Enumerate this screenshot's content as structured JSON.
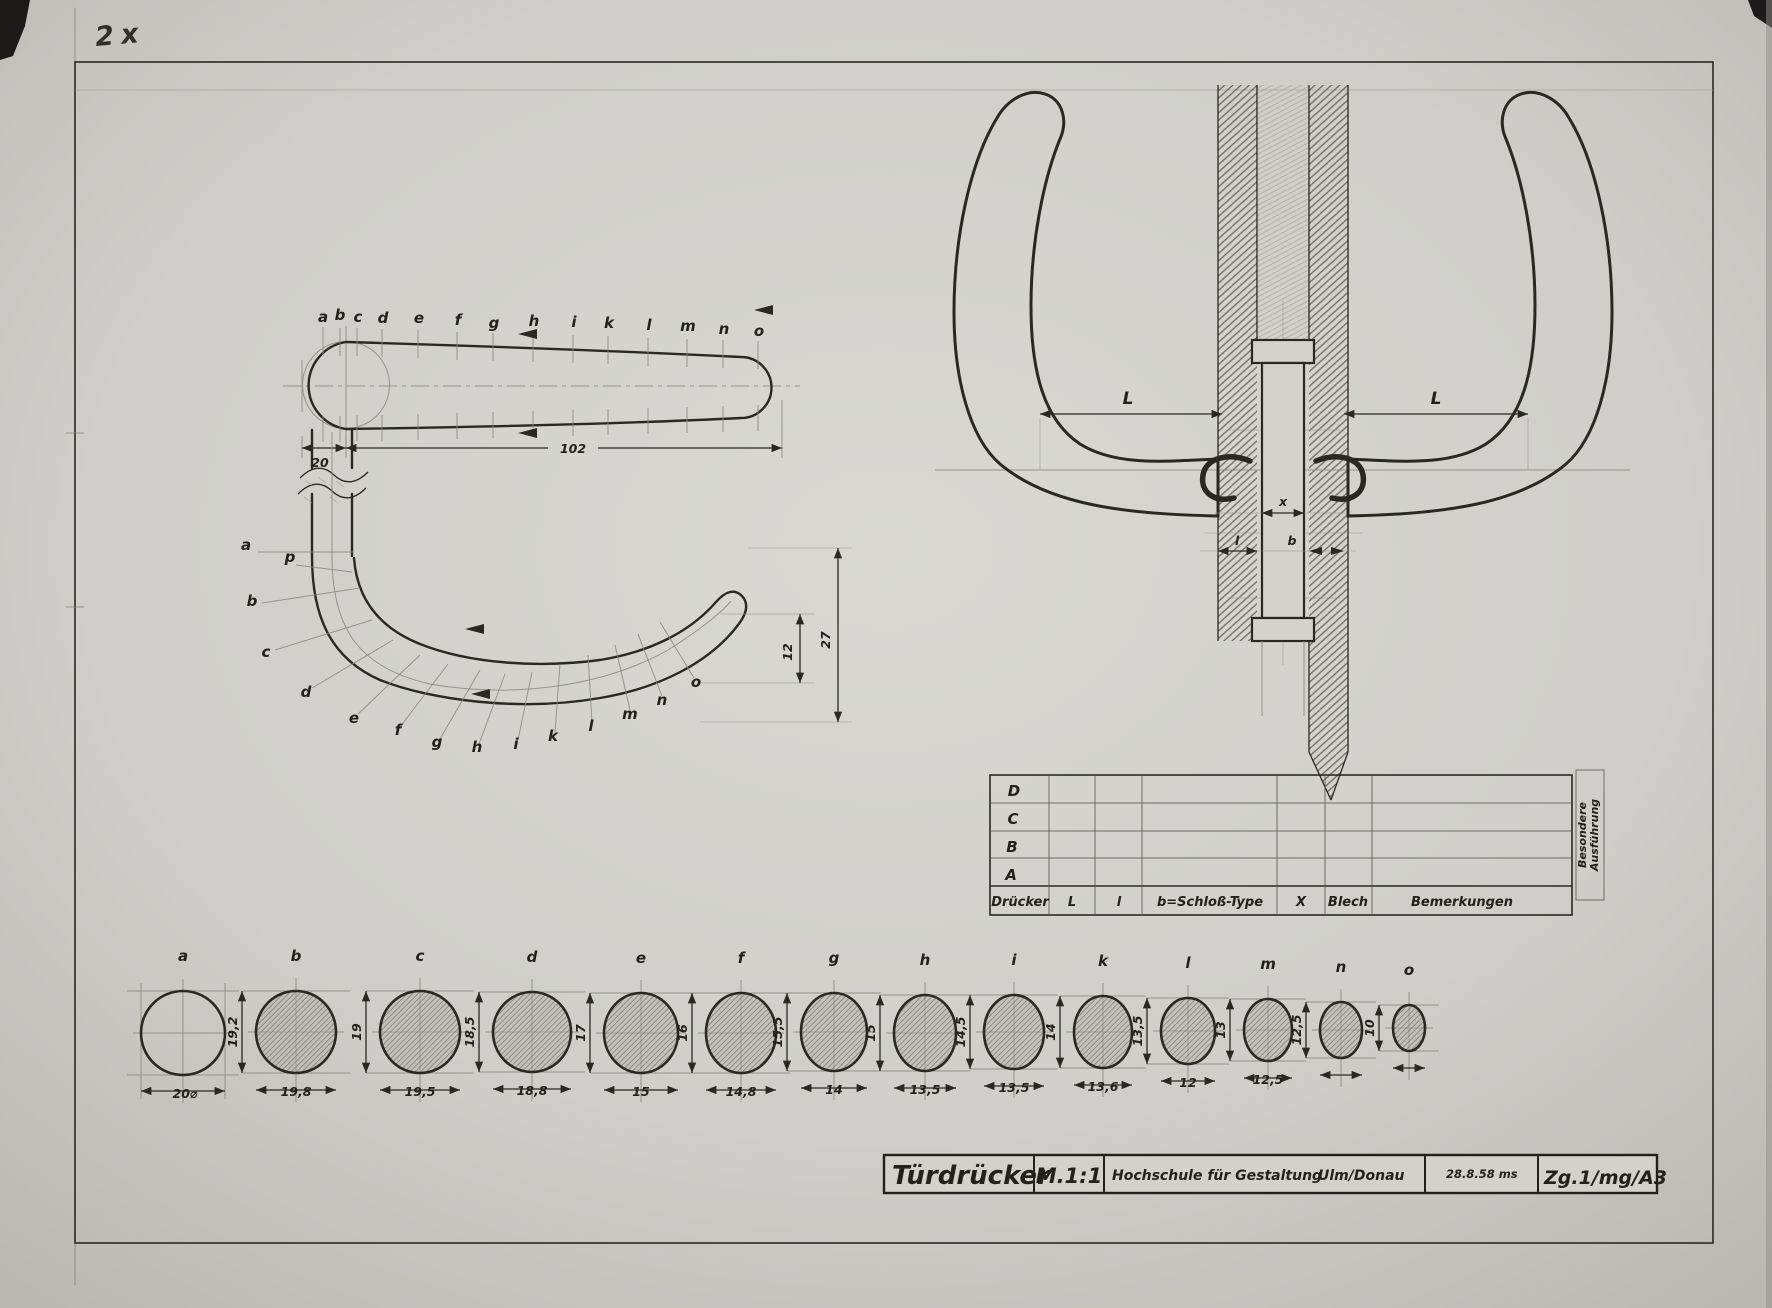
{
  "sheet": {
    "annotation": "2x"
  },
  "stations": [
    "a",
    "b",
    "c",
    "d",
    "e",
    "f",
    "g",
    "h",
    "i",
    "k",
    "l",
    "m",
    "n",
    "o"
  ],
  "side_view": {
    "dim_neck": "20",
    "dim_length": "102"
  },
  "plan_view": {
    "extra_station": "p",
    "dim_inner": "12",
    "dim_width": "27"
  },
  "front_view": {
    "dim_left": "L",
    "dim_right": "L",
    "dim_spindle": "x",
    "dim_l": "l",
    "dim_b": "b"
  },
  "spec_table": {
    "row_labels": [
      "D",
      "C",
      "B",
      "A"
    ],
    "columns": [
      "Drücker",
      "L",
      "l",
      "b=Schloß-Type",
      "X",
      "Blech",
      "Bemerkungen"
    ],
    "side_note": [
      "Besondere",
      "Ausführung"
    ]
  },
  "sections": {
    "items": [
      {
        "label": "a",
        "width": "20⌀",
        "height": ""
      },
      {
        "label": "b",
        "width": "19,8",
        "height": "19,2"
      },
      {
        "label": "c",
        "width": "19,5",
        "height": "19"
      },
      {
        "label": "d",
        "width": "18,8",
        "height": "18,5"
      },
      {
        "label": "e",
        "width": "15",
        "height": "17"
      },
      {
        "label": "f",
        "width": "14,8",
        "height": "16"
      },
      {
        "label": "g",
        "width": "14",
        "height": "15,5"
      },
      {
        "label": "h",
        "width": "13,5",
        "height": "15"
      },
      {
        "label": "i",
        "width": "13,5",
        "height": "14,5"
      },
      {
        "label": "k",
        "width": "13,6",
        "height": "14"
      },
      {
        "label": "l",
        "width": "12",
        "height": "13,5"
      },
      {
        "label": "m",
        "width": "12,5",
        "height": "13"
      },
      {
        "label": "n",
        "width": "",
        "height": "12,5"
      },
      {
        "label": "o",
        "width": "",
        "height": "10"
      }
    ]
  },
  "title_block": {
    "title": "Türdrücker",
    "scale": "M.1:1",
    "institution": "Hochschule für Gestaltung",
    "city": "Ulm/Donau",
    "date": "28.8.58 ms",
    "drawing_number": "Zg.1/mg/A3"
  }
}
